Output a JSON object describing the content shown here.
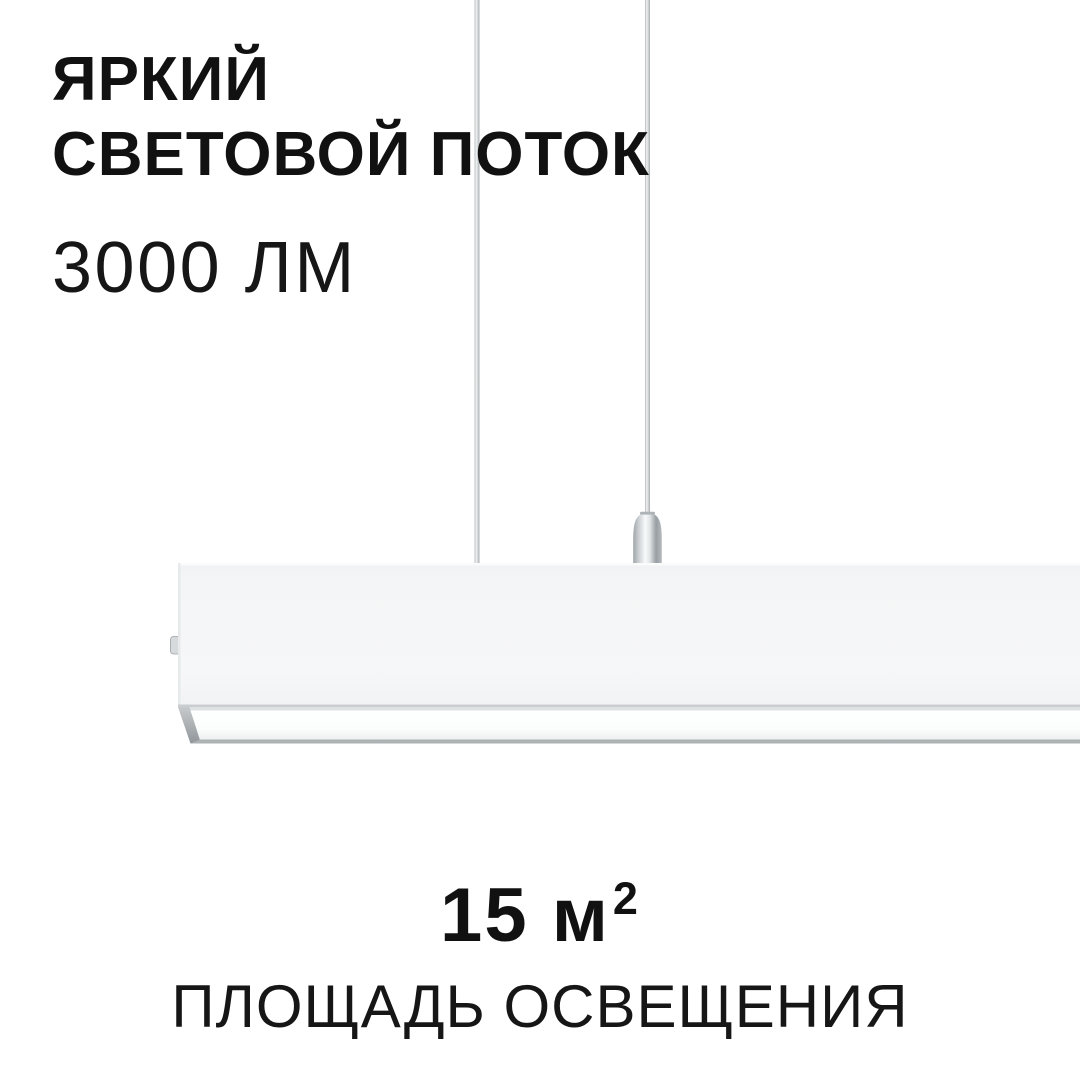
{
  "colors": {
    "background": "#ffffff",
    "text_primary": "#111111",
    "lamp_body": "#f5f6f7",
    "metal_light": "#eef0f1",
    "metal_dark": "#9aa0a4"
  },
  "headline": {
    "line1": "ЯРКИЙ",
    "line2": "СВЕТОВОЙ ПОТОК"
  },
  "luminous_flux": {
    "value": "3000 ЛМ"
  },
  "coverage_area": {
    "value": "15 м",
    "superscript": "2",
    "label": "ПЛОЩАДЬ ОСВЕЩЕНИЯ"
  }
}
